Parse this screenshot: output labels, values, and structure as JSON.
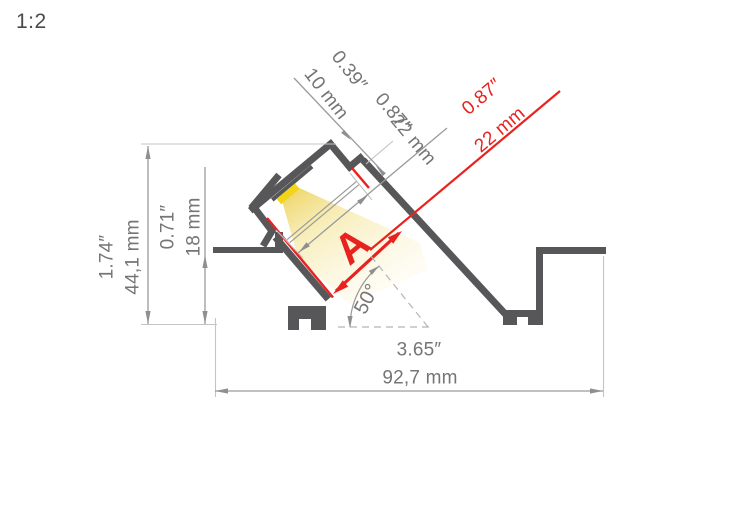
{
  "scale": {
    "label": "1:2"
  },
  "dims": {
    "slot_depth": {
      "inch": "0.39″",
      "mm": "10 mm"
    },
    "opening_width": {
      "inch": "0.87″",
      "mm": "22 mm"
    },
    "opening_width_red": {
      "inch": "0.87″",
      "mm": "22 mm"
    },
    "total_height": {
      "inch": "1.74″",
      "mm": "44,1 mm"
    },
    "recess_height": {
      "inch": "0.71″",
      "mm": "18 mm"
    },
    "total_width": {
      "inch": "3.65″",
      "mm": "92,7 mm"
    },
    "mount_angle": "50°",
    "reference_letter": "A"
  },
  "colors": {
    "accent_red": "#e8231f",
    "profile_gray": "#57575a",
    "dimension_gray": "#9a9a9a",
    "extension_gray": "#c4c4c4",
    "led_yellow": "#f2d41a",
    "light_beam_yellow": "#f6e9a8"
  }
}
